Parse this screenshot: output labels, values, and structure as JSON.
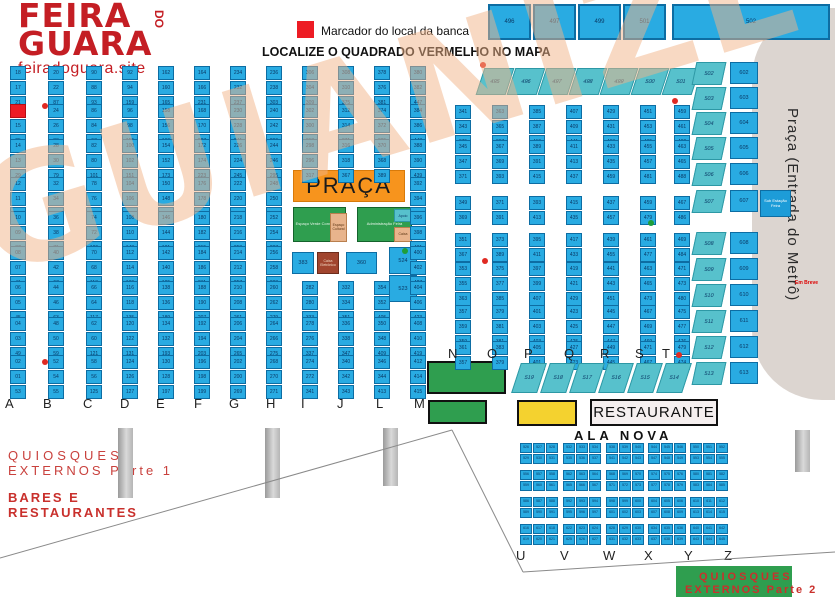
{
  "colors": {
    "stall_blue": "#29abe2",
    "teal": "#57c1cc",
    "orange": "#f7941d",
    "green": "#2f9e4f",
    "yellow": "#f4d22f",
    "red_marker": "#ed1c24",
    "brown": "#a1452e",
    "metro_gray": "#dcd5d0",
    "brand_red": "#c41e24",
    "watermark_tan": "#f2b488"
  },
  "logo": {
    "feira": "FEIRA",
    "do": "DO",
    "guara": "GUARA",
    "site": "feiradoguara.site"
  },
  "legend": {
    "marker_label": "Marcador do local da banca",
    "headline": "LOCALIZE O QUADRADO VERMELHO NO MAPA"
  },
  "main_grid": {
    "block_tops": [
      66,
      104,
      139,
      177,
      211,
      246,
      281,
      317,
      355
    ],
    "letters_y": 396,
    "columns": [
      {
        "letter": "A",
        "x": 10,
        "lx": 5,
        "left": {
          "from": 18,
          "step": -1
        },
        "right": {
          "from": 19,
          "step": 2
        },
        "marker": {
          "block": 1,
          "row": 0,
          "side": 0
        }
      },
      {
        "letter": "B",
        "x": 48,
        "lx": 43,
        "left": {
          "from": 20,
          "step": 2
        },
        "right": {
          "from": 89,
          "step": -2
        }
      },
      {
        "letter": "C",
        "x": 86,
        "lx": 83,
        "left": {
          "from": 90,
          "step": -2
        },
        "right": {
          "from": 91,
          "step": 2
        }
      },
      {
        "letter": "D",
        "x": 122,
        "lx": 120,
        "left": {
          "from": 92,
          "step": 2
        },
        "right": {
          "from": 161,
          "step": -2
        }
      },
      {
        "letter": "E",
        "x": 158,
        "lx": 156,
        "left": {
          "from": 162,
          "step": -2
        },
        "right": {
          "from": 163,
          "step": 2
        }
      },
      {
        "letter": "F",
        "x": 194,
        "lx": 194,
        "left": {
          "from": 164,
          "step": 2
        },
        "right": {
          "from": 233,
          "step": -2
        }
      },
      {
        "letter": "G",
        "x": 230,
        "lx": 229,
        "left": {
          "from": 234,
          "step": -2
        },
        "right": {
          "from": 235,
          "step": 2
        }
      },
      {
        "letter": "H",
        "x": 266,
        "lx": 266,
        "left": {
          "from": 236,
          "step": 2
        },
        "right": {
          "from": 305,
          "step": -2
        }
      },
      {
        "letter": "I",
        "x": 302,
        "lx": 301,
        "left": {
          "from": 306,
          "step": -2
        },
        "right": {
          "from": 307,
          "step": 2
        },
        "skip": [
          3,
          4,
          5
        ]
      },
      {
        "letter": "J",
        "x": 338,
        "lx": 337,
        "left": {
          "from": 308,
          "step": 2
        },
        "right": {
          "from": 377,
          "step": -2
        },
        "skip": [
          3,
          4,
          5
        ]
      },
      {
        "letter": "L",
        "x": 374,
        "lx": 376,
        "left": {
          "from": 378,
          "step": -2
        },
        "right": {
          "from": 379,
          "step": 2
        },
        "skip": [
          3,
          4,
          5
        ]
      },
      {
        "letter": "M",
        "x": 410,
        "lx": 414,
        "left": {
          "from": 380,
          "step": 2
        },
        "right": {
          "from": 449,
          "step": -2
        }
      }
    ]
  },
  "right_grid": {
    "row_tops": [
      105,
      120,
      140,
      155,
      196,
      233,
      262,
      277,
      305,
      320,
      341
    ],
    "group_xs": [
      455,
      492,
      529,
      566,
      603,
      640,
      674
    ],
    "groups": [
      {
        "left": {
          "from": 341,
          "step": 2
        },
        "right": {
          "from": 377,
          "step": -2
        }
      },
      {
        "left": {
          "from": 363,
          "step": 2
        },
        "right": {
          "from": 399,
          "step": -2
        }
      },
      {
        "left": {
          "from": 385,
          "step": 2
        },
        "right": {
          "from": 421,
          "step": -2
        }
      },
      {
        "left": {
          "from": 407,
          "step": 2
        },
        "right": {
          "from": 443,
          "step": -2
        }
      },
      {
        "left": {
          "from": 429,
          "step": 2
        },
        "right": {
          "from": 465,
          "step": -2
        }
      },
      {
        "left": {
          "from": 451,
          "step": 2
        },
        "right": {
          "from": 487,
          "step": -2
        }
      },
      {
        "left": {
          "from": 459,
          "step": 2
        },
        "right": {
          "from": 494,
          "step": -2
        }
      }
    ]
  },
  "top_rects": {
    "y": 4,
    "h": 36,
    "items": [
      {
        "x": 488,
        "w": 43,
        "label": "496"
      },
      {
        "x": 533,
        "w": 43,
        "label": "497"
      },
      {
        "x": 578,
        "w": 43,
        "label": "499"
      },
      {
        "x": 623,
        "w": 43,
        "label": "501"
      },
      {
        "x": 672,
        "w": 158,
        "label": "502"
      }
    ]
  },
  "teal_row": {
    "y": 68,
    "h": 27,
    "w": 30,
    "xs": [
      480,
      511,
      542,
      573,
      604,
      635,
      666
    ],
    "labels": [
      "495",
      "496",
      "497",
      "498",
      "499",
      "500",
      "501"
    ]
  },
  "right_cols": {
    "teal_x": 694,
    "blue_x": 730,
    "ys": [
      62,
      87,
      112,
      137,
      163,
      190,
      232,
      258,
      284,
      310,
      336,
      362
    ],
    "teal_labels": [
      "502",
      "503",
      "504",
      "505",
      "506",
      "507",
      "508",
      "509",
      "510",
      "511",
      "512",
      "513"
    ],
    "blue_labels": [
      "602",
      "603",
      "604",
      "605",
      "606",
      "607",
      "608",
      "609",
      "610",
      "611",
      "612",
      "613"
    ]
  },
  "praca": {
    "label": "PRAÇA"
  },
  "center_blocks": {
    "green_left": "Espaço Verde Convivência",
    "tan_mid": "Espaço Cultural",
    "green_right": "Administração Feira",
    "teal_sub": "Apoio",
    "tan_sub": "Caixa",
    "cell_383": "383",
    "caixa_label": "Caixa Eletrônico",
    "cell_360": "360",
    "pair_top": "524",
    "pair_bottom": "523"
  },
  "nt_letters": {
    "y": 346,
    "xs": [
      448,
      487,
      524,
      564,
      600,
      635,
      662
    ],
    "labels": [
      "N",
      "O",
      "P",
      "Q",
      "R",
      "S",
      "T"
    ]
  },
  "trap_row": {
    "y": 363,
    "h": 30,
    "w": 26,
    "xs": [
      516,
      545,
      574,
      603,
      632,
      661
    ],
    "labels": [
      "519",
      "518",
      "517",
      "516",
      "515",
      "514"
    ]
  },
  "restaurante": "RESTAURANTE",
  "ala_nova": "ALA NOVA",
  "ala_grid": {
    "start": 526,
    "col_xs": [
      520,
      563,
      606,
      648,
      690
    ],
    "row_ys": [
      443,
      470,
      497,
      524
    ]
  },
  "uz_letters": {
    "y": 548,
    "xs": [
      516,
      560,
      603,
      644,
      684,
      724
    ],
    "labels": [
      "U",
      "V",
      "W",
      "X",
      "Y",
      "Z"
    ]
  },
  "quiosques1": {
    "line1": "QUIOSQUES",
    "line2": "EXTERNOS Parte 1"
  },
  "bares": {
    "line1": "BARES E",
    "line2": "RESTAURANTES"
  },
  "quiosques2": {
    "line1": "QUIOSQUES",
    "line2": "EXTERNOS Parte 2"
  },
  "metro": {
    "label": "Praça (Entrada do Metrô)",
    "em_breve": "Em Breve",
    "sub_estacao": "Sub Estação Feira"
  },
  "watermark": "GUIANIZE",
  "markers": {
    "red": [
      [
        480,
        62
      ],
      [
        42,
        103
      ],
      [
        672,
        98
      ],
      [
        482,
        258
      ],
      [
        42,
        359
      ],
      [
        676,
        352
      ]
    ],
    "green": [
      [
        402,
        248
      ],
      [
        648,
        220
      ]
    ]
  },
  "pillars": [
    [
      118,
      428,
      70
    ],
    [
      265,
      428,
      70
    ],
    [
      383,
      428,
      58
    ],
    [
      795,
      430,
      42
    ]
  ],
  "lines": [
    [
      0,
      558,
      452,
      430
    ],
    [
      452,
      430,
      523,
      572
    ],
    [
      523,
      572,
      835,
      552
    ]
  ]
}
